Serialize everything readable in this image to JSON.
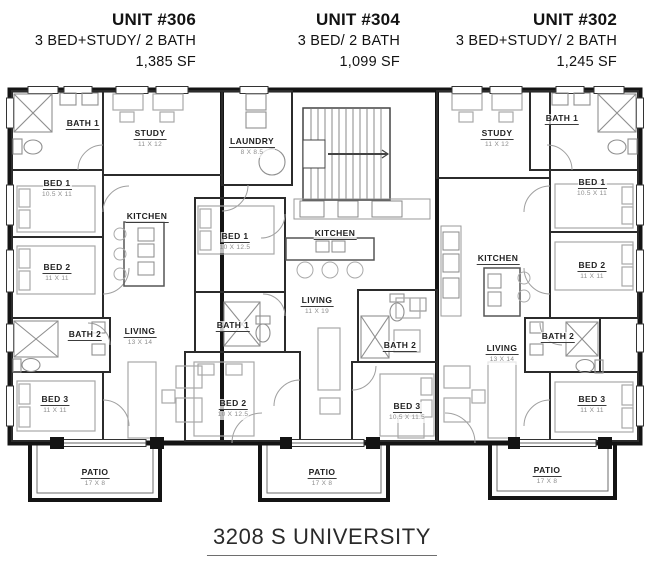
{
  "units": [
    {
      "number": "306",
      "title": "UNIT #306",
      "type": "3 BED+STUDY/ 2 BATH",
      "area": "1,385 SF",
      "rooms": [
        {
          "name": "BATH 1",
          "dims": ""
        },
        {
          "name": "STUDY",
          "dims": "11 X 12"
        },
        {
          "name": "BED 1",
          "dims": "10.5 X 11"
        },
        {
          "name": "KITCHEN",
          "dims": ""
        },
        {
          "name": "BED 2",
          "dims": "11 X 11"
        },
        {
          "name": "BATH 2",
          "dims": ""
        },
        {
          "name": "LIVING",
          "dims": "13 X 14"
        },
        {
          "name": "BED 3",
          "dims": "11 X 11"
        },
        {
          "name": "PATIO",
          "dims": "17 X 8"
        }
      ]
    },
    {
      "number": "304",
      "title": "UNIT #304",
      "type": "3 BED/ 2 BATH",
      "area": "1,099 SF",
      "rooms": [
        {
          "name": "BED 1",
          "dims": "10 X 12.5"
        },
        {
          "name": "KITCHEN",
          "dims": ""
        },
        {
          "name": "LIVING",
          "dims": "11 X 19"
        },
        {
          "name": "BATH 1",
          "dims": ""
        },
        {
          "name": "BATH 2",
          "dims": ""
        },
        {
          "name": "BED 2",
          "dims": "10 X 12.5"
        },
        {
          "name": "BED 3",
          "dims": "10.5 X 11.5"
        },
        {
          "name": "PATIO",
          "dims": "17 X 8"
        }
      ]
    },
    {
      "number": "302",
      "title": "UNIT #302",
      "type": "3 BED+STUDY/ 2 BATH",
      "area": "1,245 SF",
      "rooms": [
        {
          "name": "STUDY",
          "dims": "11 X 12"
        },
        {
          "name": "BATH 1",
          "dims": ""
        },
        {
          "name": "BED 1",
          "dims": "10.5 X 11"
        },
        {
          "name": "KITCHEN",
          "dims": ""
        },
        {
          "name": "BED 2",
          "dims": "11 X 11"
        },
        {
          "name": "BATH 2",
          "dims": ""
        },
        {
          "name": "LIVING",
          "dims": "13 X 14"
        },
        {
          "name": "BED 3",
          "dims": "11 X 11"
        },
        {
          "name": "PATIO",
          "dims": "17 X 8"
        }
      ]
    }
  ],
  "common_rooms": {
    "laundry": {
      "name": "LAUNDRY",
      "dims": "8 X 8.5"
    }
  },
  "address": "3208 S UNIVERSITY",
  "colors": {
    "ink": "#1a1a1a",
    "wall": "#141414",
    "dim_text": "#8d8d8d",
    "furniture_line": "#a8a8a8",
    "background": "#ffffff"
  }
}
